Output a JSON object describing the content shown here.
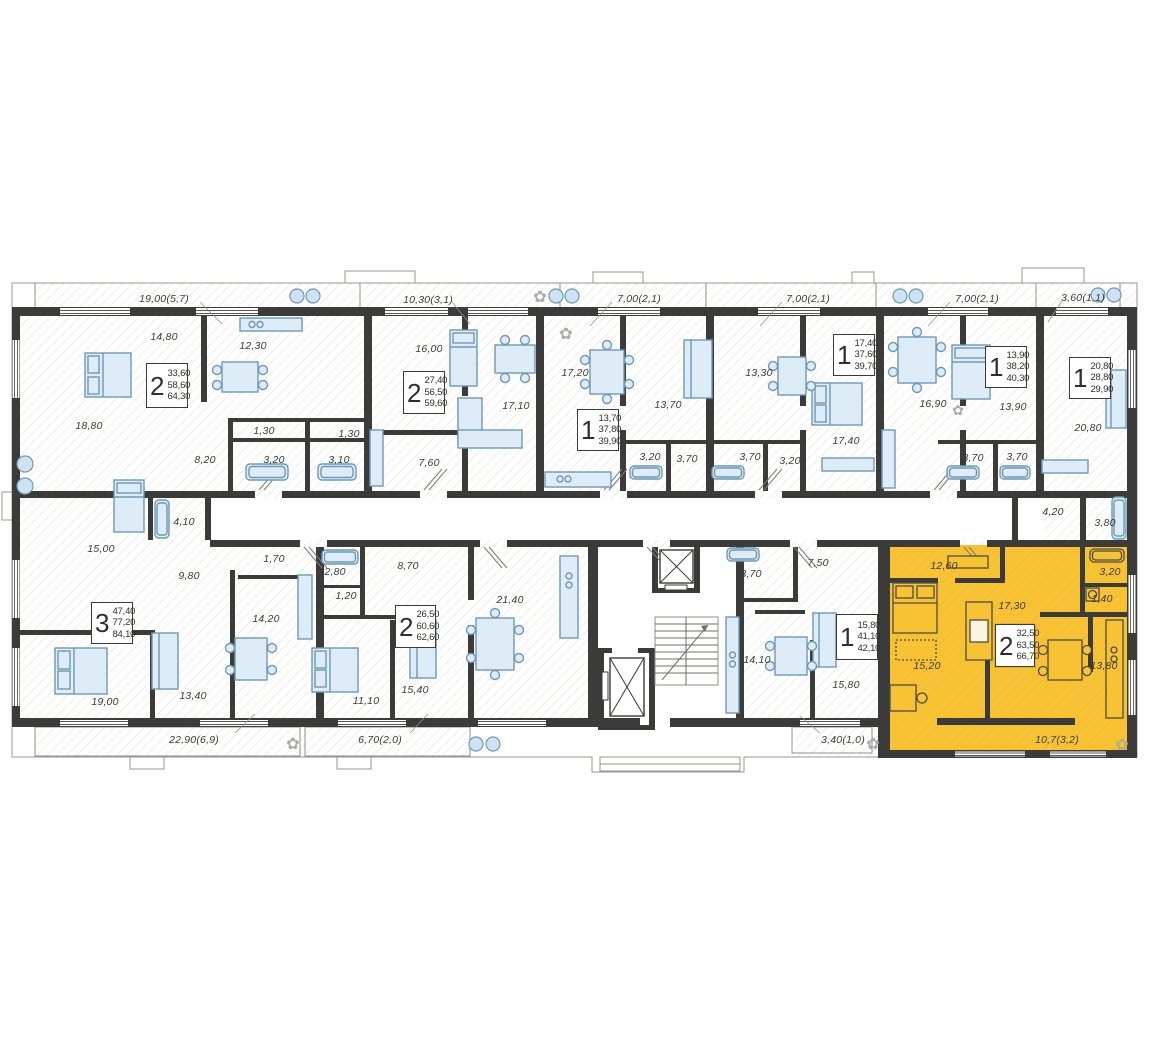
{
  "floorplan": {
    "background": "#ffffff",
    "wall_color": "#3b3b39",
    "highlight_color": "#f8c235",
    "furniture_fill": "#ddecf6",
    "furniture_stroke": "#6e99b5",
    "units": [
      {
        "rooms": "2",
        "areas": [
          "33,60",
          "58,60",
          "64,30"
        ],
        "card": {
          "x": 146,
          "y": 363,
          "w": 42,
          "h": 45
        },
        "highlighted": false
      },
      {
        "rooms": "2",
        "areas": [
          "27,40",
          "56,50",
          "59,60"
        ],
        "card": {
          "x": 403,
          "y": 371,
          "w": 42,
          "h": 43
        },
        "highlighted": false
      },
      {
        "rooms": "1",
        "areas": [
          "13,70",
          "37,80",
          "39,90"
        ],
        "card": {
          "x": 577,
          "y": 409,
          "w": 42,
          "h": 42
        },
        "highlighted": false
      },
      {
        "rooms": "1",
        "areas": [
          "17,40",
          "37,60",
          "39,70"
        ],
        "card": {
          "x": 833,
          "y": 334,
          "w": 42,
          "h": 42
        },
        "highlighted": false
      },
      {
        "rooms": "1",
        "areas": [
          "13,90",
          "38,20",
          "40,30"
        ],
        "card": {
          "x": 985,
          "y": 346,
          "w": 42,
          "h": 42
        },
        "highlighted": false
      },
      {
        "rooms": "1",
        "areas": [
          "20,80",
          "28,80",
          "29,90"
        ],
        "card": {
          "x": 1069,
          "y": 357,
          "w": 42,
          "h": 42
        },
        "highlighted": false
      },
      {
        "rooms": "3",
        "areas": [
          "47,40",
          "77,20",
          "84,10"
        ],
        "card": {
          "x": 91,
          "y": 602,
          "w": 42,
          "h": 42
        },
        "highlighted": false
      },
      {
        "rooms": "2",
        "areas": [
          "26,50",
          "60,60",
          "62,60"
        ],
        "card": {
          "x": 395,
          "y": 605,
          "w": 41,
          "h": 43
        },
        "highlighted": false
      },
      {
        "rooms": "1",
        "areas": [
          "15,80",
          "41,10",
          "42,10"
        ],
        "card": {
          "x": 836,
          "y": 614,
          "w": 42,
          "h": 46
        },
        "highlighted": false
      },
      {
        "rooms": "2",
        "areas": [
          "32,50",
          "63,50",
          "66,70"
        ],
        "card": {
          "x": 995,
          "y": 624,
          "w": 40,
          "h": 43
        },
        "highlighted": true
      }
    ],
    "room_labels": [
      {
        "text": "19,00(5,7)",
        "x": 164,
        "y": 299
      },
      {
        "text": "10,30(3,1)",
        "x": 428,
        "y": 300
      },
      {
        "text": "7,00(2,1)",
        "x": 639,
        "y": 299
      },
      {
        "text": "7,00(2,1)",
        "x": 808,
        "y": 299
      },
      {
        "text": "7,00(2,1)",
        "x": 977,
        "y": 299
      },
      {
        "text": "3,60(1,1)",
        "x": 1083,
        "y": 298
      },
      {
        "text": "14,80",
        "x": 164,
        "y": 337
      },
      {
        "text": "12,30",
        "x": 253,
        "y": 346
      },
      {
        "text": "18,80",
        "x": 89,
        "y": 426
      },
      {
        "text": "8,20",
        "x": 205,
        "y": 460
      },
      {
        "text": "1,30",
        "x": 264,
        "y": 431
      },
      {
        "text": "1,30",
        "x": 349,
        "y": 434
      },
      {
        "text": "3,20",
        "x": 274,
        "y": 460
      },
      {
        "text": "3,10",
        "x": 339,
        "y": 460
      },
      {
        "text": "16,00",
        "x": 429,
        "y": 349
      },
      {
        "text": "17,10",
        "x": 516,
        "y": 406
      },
      {
        "text": "7,60",
        "x": 429,
        "y": 463
      },
      {
        "text": "17,20",
        "x": 575,
        "y": 373
      },
      {
        "text": "13,70",
        "x": 668,
        "y": 405
      },
      {
        "text": "3,20",
        "x": 650,
        "y": 457
      },
      {
        "text": "3,70",
        "x": 687,
        "y": 459
      },
      {
        "text": "13,30",
        "x": 759,
        "y": 373
      },
      {
        "text": "17,40",
        "x": 846,
        "y": 441
      },
      {
        "text": "3,70",
        "x": 750,
        "y": 457
      },
      {
        "text": "3,20",
        "x": 790,
        "y": 461
      },
      {
        "text": "16,90",
        "x": 933,
        "y": 404
      },
      {
        "text": "13,90",
        "x": 1013,
        "y": 407
      },
      {
        "text": "3,70",
        "x": 973,
        "y": 458
      },
      {
        "text": "3,70",
        "x": 1017,
        "y": 457
      },
      {
        "text": "20,80",
        "x": 1088,
        "y": 428
      },
      {
        "text": "4,20",
        "x": 1053,
        "y": 512
      },
      {
        "text": "3,80",
        "x": 1105,
        "y": 523
      },
      {
        "text": "15,00",
        "x": 101,
        "y": 549
      },
      {
        "text": "4,10",
        "x": 184,
        "y": 522
      },
      {
        "text": "9,80",
        "x": 189,
        "y": 576
      },
      {
        "text": "1,70",
        "x": 274,
        "y": 559
      },
      {
        "text": "14,20",
        "x": 266,
        "y": 619
      },
      {
        "text": "19,00",
        "x": 105,
        "y": 702
      },
      {
        "text": "13,40",
        "x": 193,
        "y": 696
      },
      {
        "text": "2,80",
        "x": 335,
        "y": 572
      },
      {
        "text": "1,20",
        "x": 346,
        "y": 596
      },
      {
        "text": "8,70",
        "x": 408,
        "y": 566
      },
      {
        "text": "21,40",
        "x": 510,
        "y": 600
      },
      {
        "text": "15,40",
        "x": 415,
        "y": 690
      },
      {
        "text": "11,10",
        "x": 366,
        "y": 701
      },
      {
        "text": "3,70",
        "x": 751,
        "y": 574
      },
      {
        "text": "7,50",
        "x": 818,
        "y": 563
      },
      {
        "text": "14,10",
        "x": 757,
        "y": 660
      },
      {
        "text": "15,80",
        "x": 846,
        "y": 685
      },
      {
        "text": "12,60",
        "x": 944,
        "y": 566
      },
      {
        "text": "17,30",
        "x": 1012,
        "y": 606
      },
      {
        "text": "15,20",
        "x": 927,
        "y": 666
      },
      {
        "text": "13,80",
        "x": 1104,
        "y": 666
      },
      {
        "text": "3,20",
        "x": 1110,
        "y": 572
      },
      {
        "text": "1,40",
        "x": 1102,
        "y": 599
      },
      {
        "text": "22,90(6,9)",
        "x": 194,
        "y": 740
      },
      {
        "text": "6,70(2,0)",
        "x": 380,
        "y": 740
      },
      {
        "text": "3,40(1,0)",
        "x": 843,
        "y": 740
      },
      {
        "text": "10,7(3,2)",
        "x": 1057,
        "y": 740
      }
    ]
  }
}
